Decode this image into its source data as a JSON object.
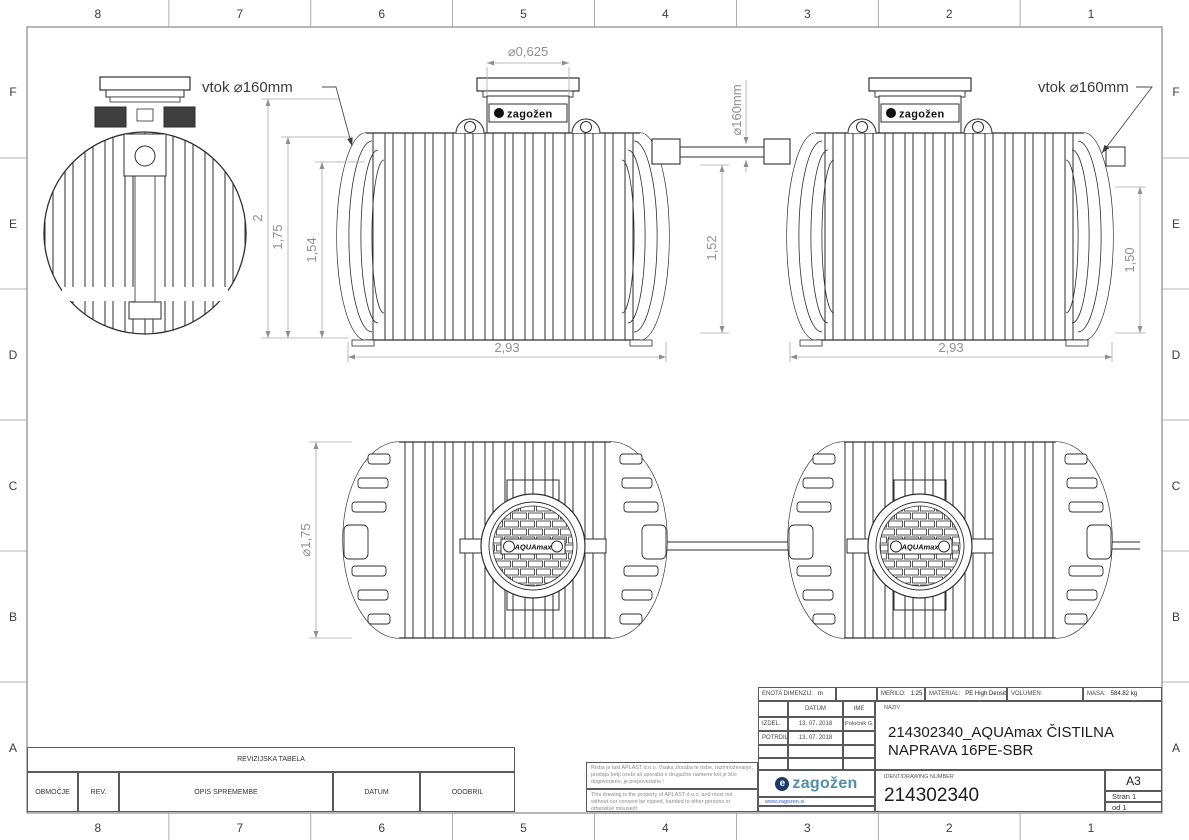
{
  "frame": {
    "columns": [
      "8",
      "7",
      "6",
      "5",
      "4",
      "3",
      "2",
      "1"
    ],
    "rows": [
      "F",
      "E",
      "D",
      "C",
      "B",
      "A"
    ]
  },
  "dims": {
    "d2": "2",
    "d175": "1,75",
    "d154": "1,54",
    "d152": "1,52",
    "d150": "1,50",
    "len1": "2,93",
    "len2": "2,93",
    "neck": "⌀0,625",
    "pipe": "⌀160mm",
    "dia": "⌀1,75",
    "vtok1": "vtok ⌀160mm",
    "vtok2": "vtok ⌀160mm"
  },
  "brand": {
    "tank_badge": "zagožen",
    "manhole_label": "AQUAmax"
  },
  "legal": {
    "sl": "Risba je last APLAST d.o.o. Vsaka zloraba te risbe, razmnoževanje, prodaja tretji osebi ali uporaba v drugačne namene kot je bilo dogovorjeno, je prepovedana !",
    "en": "This drawing is the property of APLAST d.o.o. and must not , without our consent be copied, handed to other persons or otherwise misused!"
  },
  "revision_table": {
    "title": "REVIZIJSKA TABELA",
    "columns": [
      "OBMOČJE",
      "REV.",
      "OPIS SPREMEMBE",
      "DATUM",
      "ODOBRIL"
    ]
  },
  "title_block": {
    "unit_label": "ENOTA DIMENZIJ:",
    "unit_value": "m",
    "scale_label": "MERILO:",
    "scale_value": "1:25",
    "material_label": "MATERIAL:",
    "material_value": "PE High Density",
    "volume_label": "VOLUMEN:",
    "mass_label": "MASA:",
    "mass_value": "584.82 kg",
    "date_header": "DATUM",
    "name_header": "IME",
    "made_label": "IZDEL.",
    "made_date": "13. 07. 2018",
    "made_name": "Poločnik G.",
    "approved_label": "POTRDIL",
    "approved_date": "13. 07. 2018",
    "naziv_label": "NAZIV",
    "naziv_value": "214302340_AQUAmax ČISTILNA NAPRAVA 16PE-SBR",
    "ident_label": "IDENT/DRAWING NUMBER",
    "ident_value": "214302340",
    "format": "A3",
    "page": "Stran 1",
    "page_of": "od 1",
    "logo_text": "zagožen",
    "website": "www.zagozen.si"
  },
  "colors": {
    "logo_blue": "#4e8fae",
    "logo_navy": "#1d3a6b",
    "link_blue": "#3b5bd6",
    "line_dark": "#2e2e2e",
    "dim_gray": "#8f8f8f"
  }
}
